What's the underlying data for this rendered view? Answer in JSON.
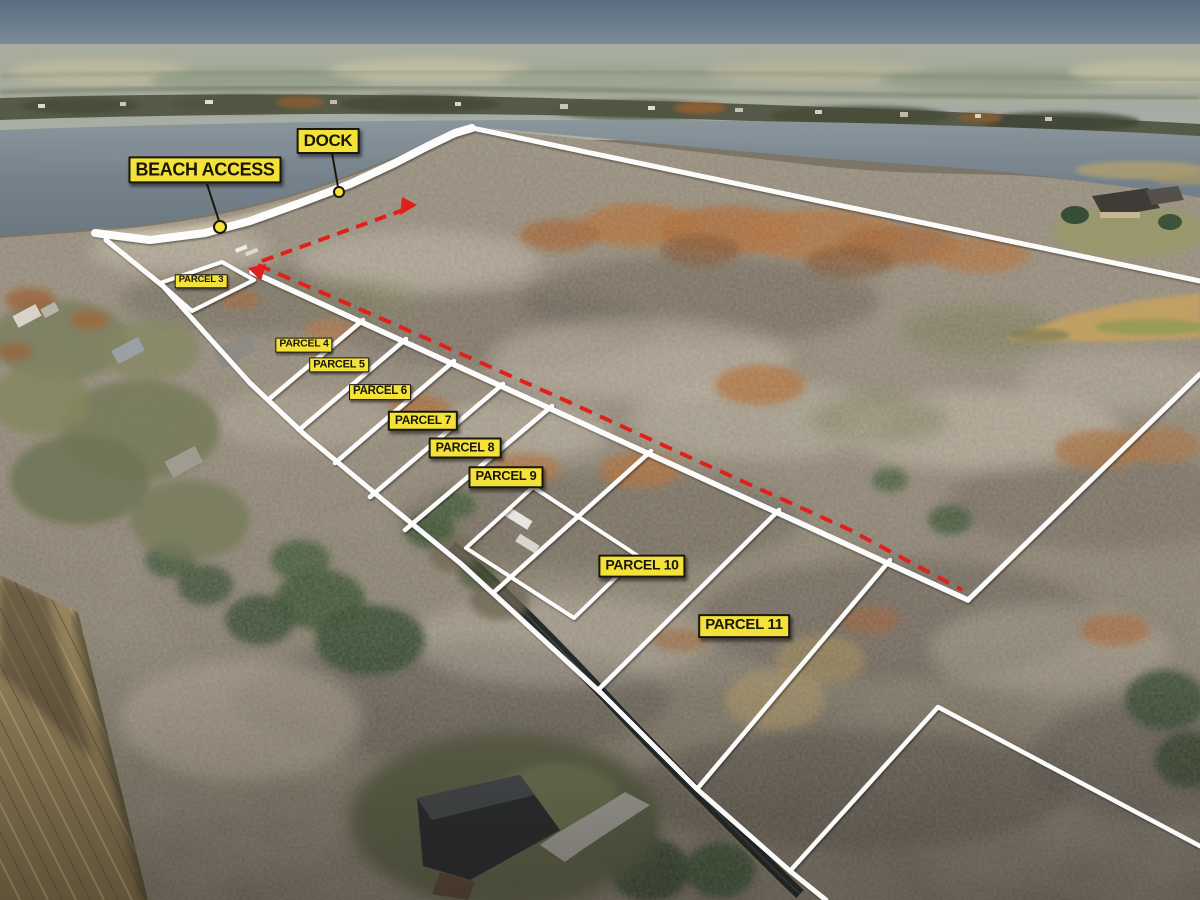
{
  "image_type": "aerial-parcel-map",
  "colors": {
    "label_bg": "#f3e23a",
    "label_text": "#1a1708",
    "boundary_white": "#ffffff",
    "route_red": "#e0201a",
    "callout_line": "#1a1708",
    "lake": "#75828c",
    "autumn_woods": "#8a8171",
    "field": "#8d7b55"
  },
  "callouts": [
    {
      "id": "beach-access",
      "text": "BEACH ACCESS",
      "cx": 205,
      "cy": 170,
      "fs": 18,
      "dot": {
        "x": 220,
        "y": 227,
        "r": 6
      },
      "line": [
        [
          207,
          184
        ],
        [
          219,
          221
        ]
      ]
    },
    {
      "id": "dock",
      "text": "DOCK",
      "cx": 328,
      "cy": 141,
      "fs": 17,
      "dot": {
        "x": 339,
        "y": 192,
        "r": 5
      },
      "line": [
        [
          332,
          153
        ],
        [
          338,
          187
        ]
      ]
    }
  ],
  "parcel_labels": [
    {
      "text": "PARCEL 3",
      "cx": 201,
      "cy": 281,
      "fs": 9.5
    },
    {
      "text": "PARCEL 4",
      "cx": 304,
      "cy": 345,
      "fs": 10.5
    },
    {
      "text": "PARCEL 5",
      "cx": 339,
      "cy": 365,
      "fs": 11
    },
    {
      "text": "PARCEL 6",
      "cx": 380,
      "cy": 392,
      "fs": 11.5
    },
    {
      "text": "PARCEL 7",
      "cx": 423,
      "cy": 421,
      "fs": 12
    },
    {
      "text": "PARCEL 8",
      "cx": 465,
      "cy": 448,
      "fs": 12.5
    },
    {
      "text": "PARCEL 9",
      "cx": 506,
      "cy": 477,
      "fs": 13
    },
    {
      "text": "PARCEL 10",
      "cx": 642,
      "cy": 566,
      "fs": 14
    },
    {
      "text": "PARCEL 11",
      "cx": 744,
      "cy": 626,
      "fs": 15
    }
  ],
  "boundary_lines": [
    {
      "name": "shoreline-band",
      "width": 8,
      "points": [
        [
          95,
          233
        ],
        [
          150,
          240
        ],
        [
          205,
          233
        ],
        [
          250,
          221
        ],
        [
          300,
          203
        ],
        [
          350,
          184
        ],
        [
          395,
          163
        ],
        [
          428,
          146
        ],
        [
          455,
          133
        ],
        [
          472,
          128
        ]
      ]
    },
    {
      "name": "north-boundary",
      "width": 5,
      "points": [
        [
          472,
          128
        ],
        [
          1200,
          281
        ]
      ]
    },
    {
      "name": "west-edge",
      "width": 5,
      "points": [
        [
          106,
          240
        ],
        [
          163,
          286
        ]
      ]
    },
    {
      "name": "road-front-line",
      "width": 5,
      "points": [
        [
          163,
          286
        ],
        [
          205,
          333
        ],
        [
          250,
          383
        ],
        [
          305,
          435
        ],
        [
          383,
          500
        ],
        [
          460,
          563
        ],
        [
          520,
          618
        ],
        [
          602,
          694
        ],
        [
          697,
          789
        ],
        [
          790,
          871
        ],
        [
          826,
          900
        ]
      ]
    },
    {
      "name": "rear-lot-line",
      "width": 5.5,
      "points": [
        [
          252,
          272
        ],
        [
          968,
          600
        ]
      ]
    },
    {
      "name": "east-boundary",
      "width": 5,
      "points": [
        [
          968,
          600
        ],
        [
          1200,
          374
        ]
      ]
    },
    {
      "name": "parcel3-outline",
      "width": 4,
      "points": [
        [
          160,
          283
        ],
        [
          222,
          262
        ],
        [
          254,
          280
        ],
        [
          192,
          311
        ],
        [
          160,
          283
        ]
      ]
    },
    {
      "name": "divider-4-5",
      "width": 4.5,
      "points": [
        [
          268,
          400
        ],
        [
          363,
          320
        ]
      ]
    },
    {
      "name": "divider-5-6",
      "width": 4.5,
      "points": [
        [
          299,
          430
        ],
        [
          406,
          339
        ]
      ]
    },
    {
      "name": "divider-6-7",
      "width": 4.5,
      "points": [
        [
          335,
          463
        ],
        [
          454,
          361
        ]
      ]
    },
    {
      "name": "divider-7-8",
      "width": 4.5,
      "points": [
        [
          370,
          497
        ],
        [
          503,
          384
        ]
      ]
    },
    {
      "name": "divider-8-9",
      "width": 4.5,
      "points": [
        [
          405,
          530
        ],
        [
          552,
          406
        ]
      ]
    },
    {
      "name": "home-lot-outline",
      "width": 4,
      "points": [
        [
          533,
          487
        ],
        [
          638,
          556
        ],
        [
          574,
          618
        ],
        [
          466,
          548
        ],
        [
          533,
          487
        ]
      ]
    },
    {
      "name": "divider-9-10",
      "width": 4.5,
      "points": [
        [
          493,
          593
        ],
        [
          651,
          451
        ]
      ]
    },
    {
      "name": "divider-10-11",
      "width": 4.5,
      "points": [
        [
          598,
          690
        ],
        [
          779,
          510
        ]
      ]
    },
    {
      "name": "parcel11-se-edge",
      "width": 4.5,
      "points": [
        [
          697,
          789
        ],
        [
          890,
          560
        ]
      ]
    },
    {
      "name": "se-corner-lines",
      "width": 4.5,
      "points": [
        [
          790,
          871
        ],
        [
          938,
          707
        ],
        [
          1200,
          846
        ]
      ]
    }
  ],
  "route_lines": [
    {
      "name": "access-route",
      "width": 4,
      "dash": "13 9",
      "points": [
        [
          258,
          265
        ],
        [
          330,
          296
        ],
        [
          430,
          340
        ],
        [
          560,
          398
        ],
        [
          700,
          462
        ],
        [
          850,
          530
        ],
        [
          962,
          590
        ]
      ],
      "arrow": "248,268 266,264 261,281"
    },
    {
      "name": "dock-route",
      "width": 4,
      "dash": "12 8",
      "points": [
        [
          262,
          261
        ],
        [
          406,
          209
        ]
      ],
      "arrow": "417,205 400,215 402,197"
    }
  ]
}
